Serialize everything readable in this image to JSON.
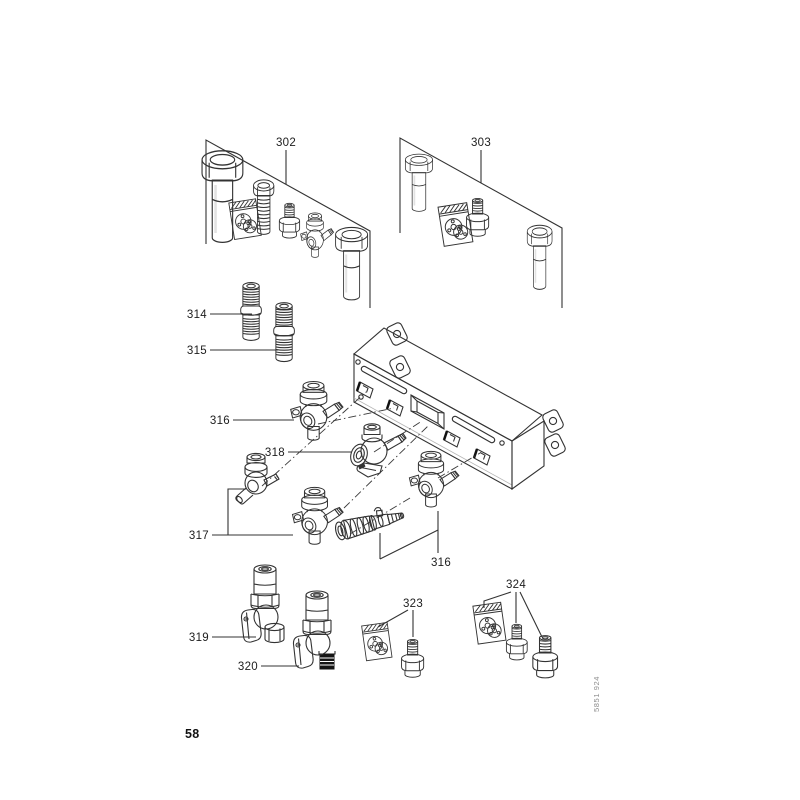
{
  "page": {
    "number": "58",
    "doc_code": "5851 924"
  },
  "diagram": {
    "type": "exploded-parts-diagram",
    "callouts": {
      "302": "302",
      "303": "303",
      "314": "314",
      "315": "315",
      "316a": "316",
      "316b": "316",
      "317": "317",
      "318": "318",
      "319": "319",
      "320": "320",
      "323": "323",
      "324": "324"
    }
  }
}
